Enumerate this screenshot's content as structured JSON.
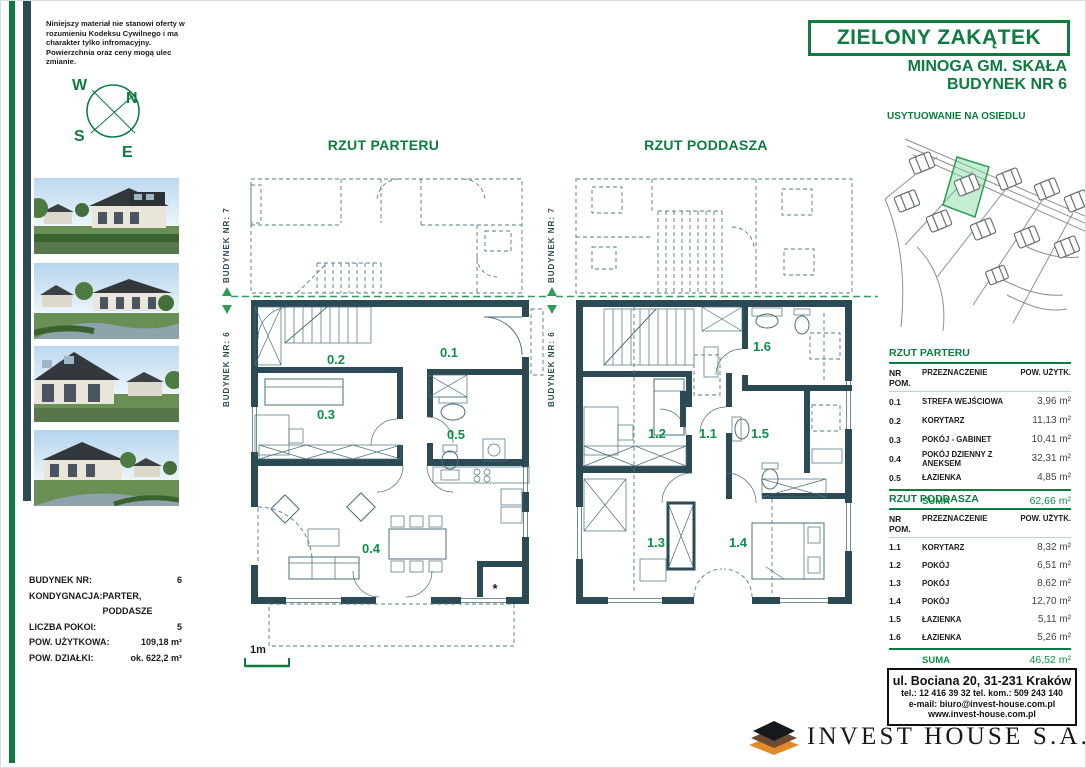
{
  "disclaimer": "Niniejszy materiał nie stanowi oferty w rozumieniu Kodeksu Cywilnego i ma charakter tylko infromacyjny. Powierzchnia oraz ceny mogą ulec zmianie.",
  "compass": {
    "n": "N",
    "e": "E",
    "s": "S",
    "w": "W"
  },
  "header": {
    "title": "ZIELONY ZAKĄTEK",
    "location": "MINOGA GM. SKAŁA",
    "building": "BUDYNEK NR 6"
  },
  "site_plan": {
    "title": "USYTUOWANIE NA OSIEDLU"
  },
  "floor_plans": {
    "parter": {
      "title": "RZUT PARTERU",
      "neighbor_label": "BUDYNEK NR: 7",
      "self_label": "BUDYNEK NR: 6",
      "scale_label": "1m",
      "asterisk": "*",
      "rooms": {
        "r01": "0.1",
        "r02": "0.2",
        "r03": "0.3",
        "r04": "0.4",
        "r05": "0.5"
      }
    },
    "poddasze": {
      "title": "RZUT PODDASZA",
      "neighbor_label": "BUDYNEK NR: 7",
      "self_label": "BUDYNEK NR: 6",
      "rooms": {
        "r11": "1.1",
        "r12": "1.2",
        "r13": "1.3",
        "r14": "1.4",
        "r15": "1.5",
        "r16": "1.6"
      }
    }
  },
  "building_info": {
    "rows": [
      {
        "label": "BUDYNEK NR:",
        "value": "6"
      },
      {
        "label": "KONDYGNACJA:",
        "value": "PARTER, PODDASZE"
      },
      {
        "label": "LICZBA POKOI:",
        "value": "5"
      },
      {
        "label": "POW. UŻYTKOWA:",
        "value": "109,18 m²"
      },
      {
        "label": "POW. DZIAŁKI:",
        "value": "ok. 622,2 m²"
      }
    ]
  },
  "tables": {
    "parter": {
      "title": "RZUT PARTERU",
      "headers": [
        "NR POM.",
        "PRZEZNACZENIE",
        "POW. UŻYTK."
      ],
      "rows": [
        [
          "0.1",
          "STREFA WEJŚCIOWA",
          "3,96 m²"
        ],
        [
          "0.2",
          "KORYTARZ",
          "11,13 m²"
        ],
        [
          "0.3",
          "POKÓJ - GABINET",
          "10,41 m²"
        ],
        [
          "0.4",
          "POKÓJ DZIENNY Z ANEKSEM",
          "32,31 m²"
        ],
        [
          "0.5",
          "ŁAZIENKA",
          "4,85 m²"
        ]
      ],
      "suma_label": "SUMA",
      "suma_value": "62,66 m²"
    },
    "poddasze": {
      "title": "RZUT PODDASZA",
      "headers": [
        "NR POM.",
        "PRZEZNACZENIE",
        "POW. UŻYTK."
      ],
      "rows": [
        [
          "1.1",
          "KORYTARZ",
          "8,32 m²"
        ],
        [
          "1.2",
          "POKÓJ",
          "6,51 m²"
        ],
        [
          "1.3",
          "POKÓJ",
          "8,62 m²"
        ],
        [
          "1.4",
          "POKÓJ",
          "12,70 m²"
        ],
        [
          "1.5",
          "ŁAZIENKA",
          "5,11 m²"
        ],
        [
          "1.6",
          "ŁAZIENKA",
          "5,26 m²"
        ]
      ],
      "suma_label": "SUMA",
      "suma_value": "46,52 m²"
    }
  },
  "contact": {
    "address": "ul. Bociana 20, 31-231 Kraków",
    "phone": "tel.: 12 416 39 32   tel. kom.: 509 243 140",
    "email": "e-mail: biuro@invest-house.com.pl",
    "website": "www.invest-house.com.pl"
  },
  "logo": {
    "text": "INVEST HOUSE S.A."
  }
}
